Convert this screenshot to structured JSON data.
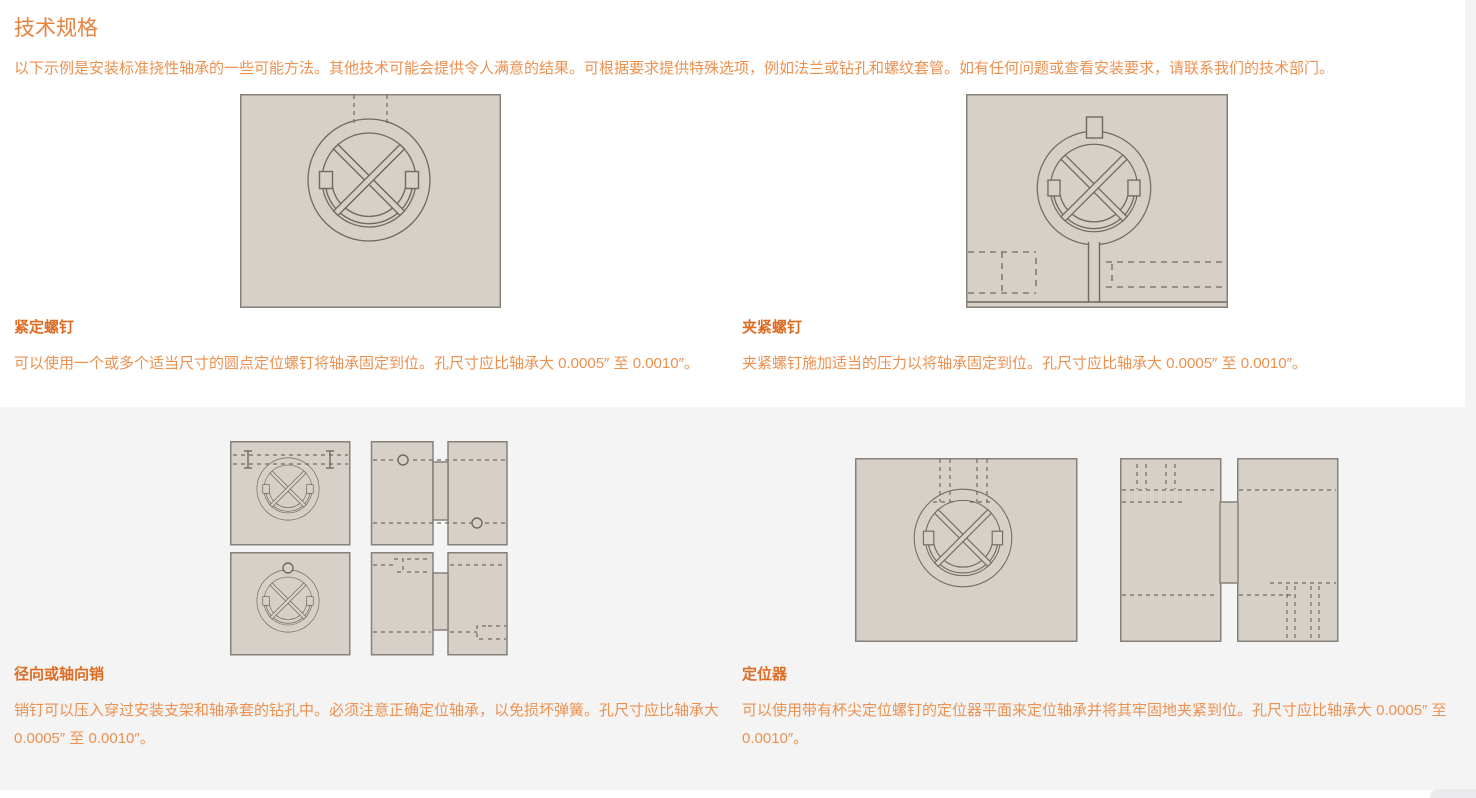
{
  "page": {
    "title": "技术规格",
    "intro": "以下示例是安装标准挠性轴承的一些可能方法。其他技术可能会提供令人满意的结果。可根据要求提供特殊选项，例如法兰或钻孔和螺纹套管。如有任何问题或查看安装要求，请联系我们的技术部门。"
  },
  "methods": [
    {
      "name": "紧定螺钉",
      "description": "可以使用一个或多个适当尺寸的圆点定位螺钉将轴承固定到位。孔尺寸应比轴承大 0.0005″ 至 0.0010″。",
      "diagram": "set-screw-front-view"
    },
    {
      "name": "夹紧螺钉",
      "description": "夹紧螺钉施加适当的压力以将轴承固定到位。孔尺寸应比轴承大 0.0005″ 至 0.0010″。",
      "diagram": "clamp-screw-front-view"
    },
    {
      "name": "径向或轴向销",
      "description": "销钉可以压入穿过安装支架和轴承套的钻孔中。必须注意正确定位轴承，以免损坏弹簧。孔尺寸应比轴承大 0.0005″ 至 0.0010″。",
      "diagram": "radial-axial-pin-views"
    },
    {
      "name": "定位器",
      "description": "可以使用带有杯尖定位螺钉的定位器平面来定位轴承并将其牢固地夹紧到位。孔尺寸应比轴承大 0.0005″ 至 0.0010″。",
      "diagram": "locator-views"
    }
  ],
  "colors": {
    "heading_orange": "#e8823c",
    "label_orange": "#de6c22",
    "body_orange": "#ec9150",
    "diagram_fill": "#d6d0c8",
    "diagram_line": "#6f695f",
    "section_background": "#f4f4f5"
  }
}
